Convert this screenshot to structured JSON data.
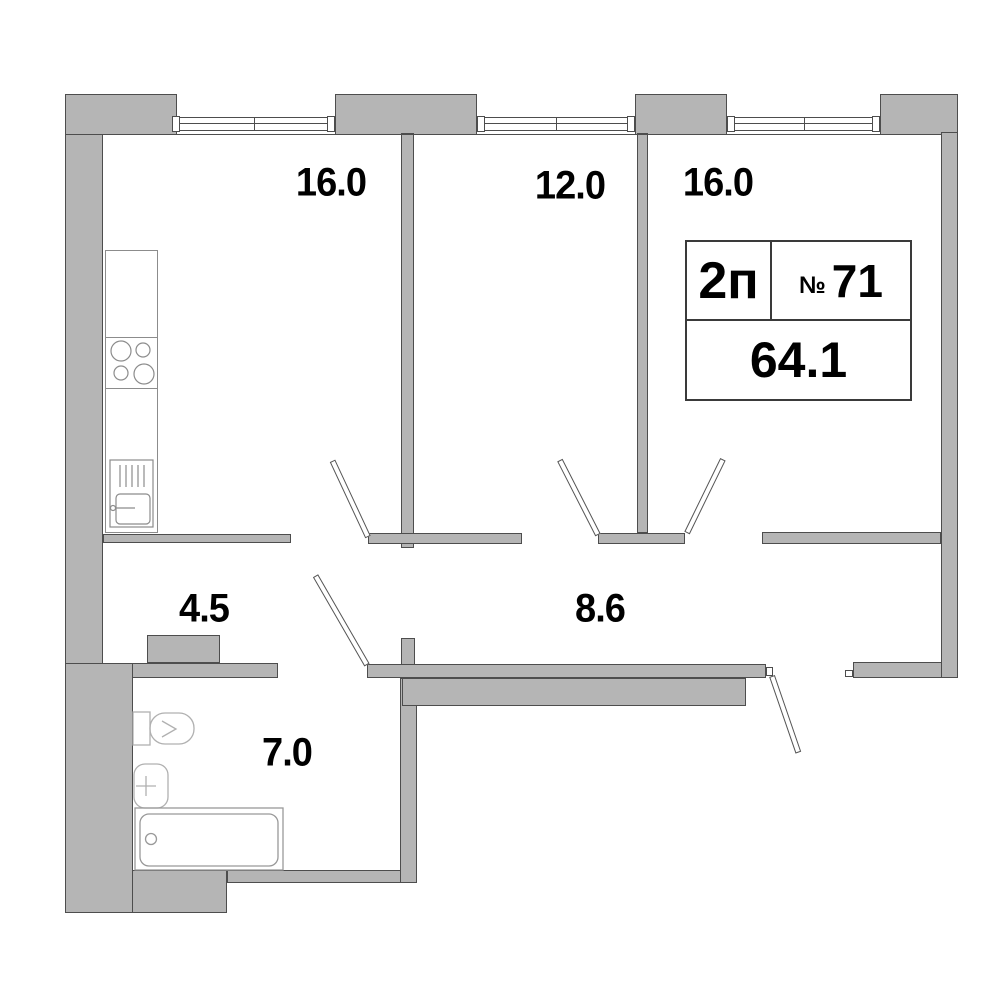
{
  "plan": {
    "info": {
      "unit_type": "2п",
      "number_symbol": "№",
      "number": "71",
      "total_area": "64.1"
    },
    "rooms": [
      {
        "name": "living-kitchen",
        "area": "16.0"
      },
      {
        "name": "bedroom",
        "area": "12.0"
      },
      {
        "name": "bedroom-2",
        "area": "16.0"
      },
      {
        "name": "hall",
        "area": "4.5"
      },
      {
        "name": "corridor",
        "area": "8.6"
      },
      {
        "name": "bathroom",
        "area": "7.0"
      }
    ],
    "colors": {
      "wall_fill": "#b5b5b5",
      "wall_outline": "#4d4d4d",
      "fixture_line": "#b0b0b0",
      "label_text": "#000000"
    }
  }
}
